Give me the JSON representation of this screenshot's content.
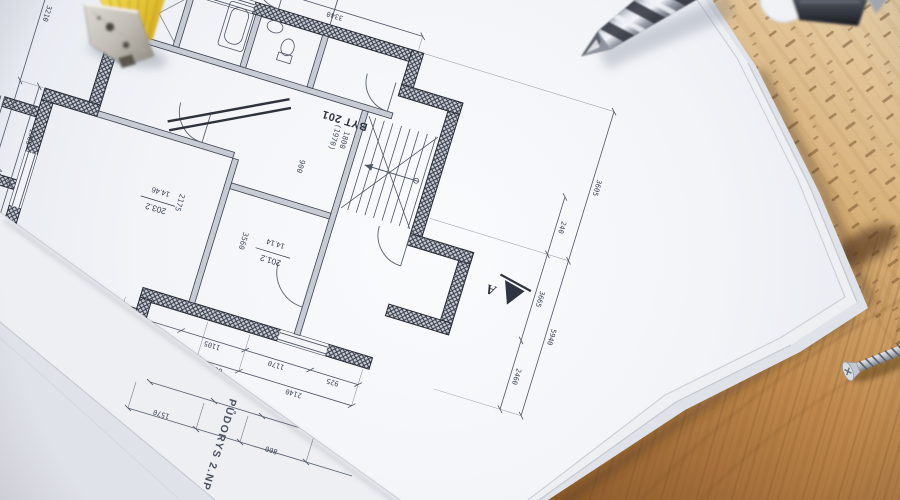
{
  "scene": {
    "type": "photograph",
    "subject": "Architectural floor-plan blueprint sheets lying on a wooden desk with a metal drill bit, a folding-ruler clamp and a wood screw",
    "colors": {
      "wood_light": "#e6cda6",
      "wood_dark": "#8f5d2e",
      "paper": "#f2f4f8",
      "plan_line": "#4e5564",
      "wall_fill": "#343a46",
      "ruler_yellow": "#ecd04a",
      "steel": "#c9cdd6"
    }
  },
  "blueprint": {
    "title": "PŮDORYS 2.NP",
    "apartment_label": "BYT 201",
    "section_marker": "A",
    "rooms": [
      {
        "number": "201.2",
        "area": "14.14"
      },
      {
        "number": "203.2",
        "area": "14.46"
      }
    ],
    "dims": [
      "2140",
      "800",
      "1570",
      "1370",
      "925",
      "1170",
      "1105",
      "600",
      "5940",
      "3605",
      "2460",
      "3665",
      "4160",
      "3210",
      "1420",
      "990",
      "1985",
      "3340",
      "2175",
      "3560",
      "900",
      "1800",
      "(1970)",
      "240"
    ]
  }
}
